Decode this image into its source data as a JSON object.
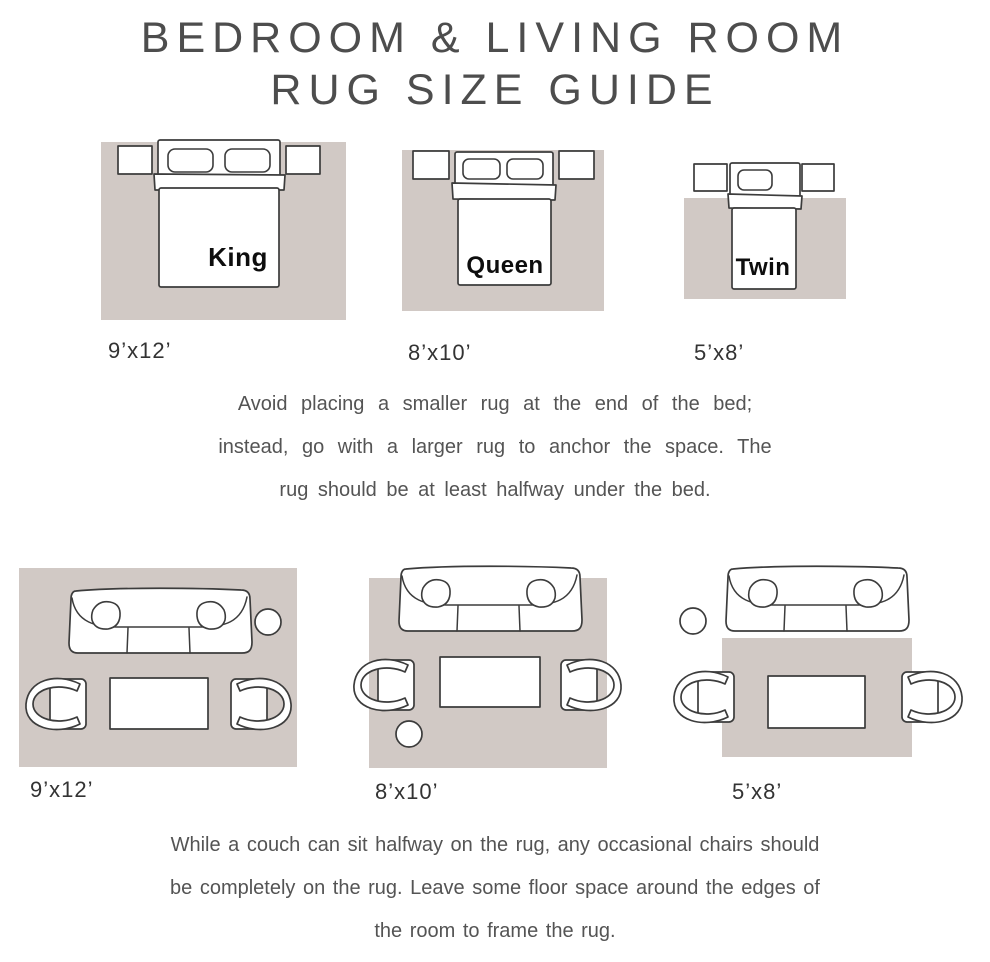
{
  "title": {
    "line1": "BEDROOM & LIVING ROOM",
    "line2": "RUG SIZE GUIDE"
  },
  "colors": {
    "rug": "#d1c9c5",
    "outline": "#3c3c3c",
    "title_text": "#4d4d4d",
    "body_text": "#545454",
    "size_text": "#333333",
    "bed_label": "#0d0d0d"
  },
  "bedroom": {
    "figures": [
      {
        "bed_label": "King",
        "size_label": "9’x12’"
      },
      {
        "bed_label": "Queen",
        "size_label": "8’x10’"
      },
      {
        "bed_label": "Twin",
        "size_label": "5’x8’"
      }
    ],
    "note_lines": [
      "Avoid placing a smaller rug at the end of the bed;",
      "instead, go with a larger rug to anchor the space. The",
      "rug should be at least halfway under the bed."
    ]
  },
  "living": {
    "figures": [
      {
        "size_label": "9’x12’"
      },
      {
        "size_label": "8’x10’"
      },
      {
        "size_label": "5’x8’"
      }
    ],
    "note_lines": [
      "While a couch can sit halfway on the rug, any occasional chairs should",
      "be completely on the rug. Leave some floor space around the edges of",
      "the room to frame the rug."
    ]
  }
}
